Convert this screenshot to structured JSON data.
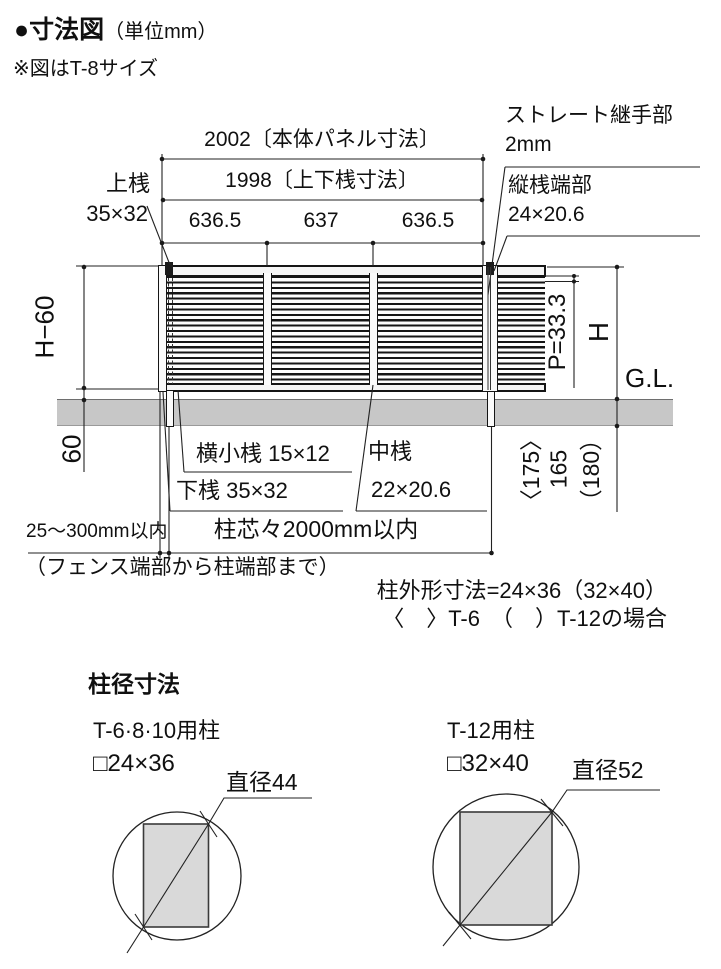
{
  "header": {
    "title": "●寸法図",
    "unit": "（単位mm）",
    "note": "※図はT-8サイズ"
  },
  "dims": {
    "panel_width": "2002〔本体パネル寸法〕",
    "rail_width": "1998〔上下桟寸法〕",
    "segments": [
      "636.5",
      "637",
      "636.5"
    ],
    "top_rail_label": "上桟",
    "top_rail_size": "35×32",
    "joint_label": "ストレート継手部",
    "joint_size": "2mm",
    "vertical_end_label": "縦桟端部",
    "vertical_end_size": "24×20.6",
    "panel_height": "H−60",
    "pitch": "P=33.3",
    "total_height": "H",
    "ground_level": "G.L.",
    "ground_clearance": "60",
    "embed_t6": "〈175〉",
    "embed_t8": "165",
    "embed_t12": "（180）",
    "small_rail": "横小桟 15×12",
    "bottom_rail": "下桟 35×32",
    "middle_rail_label": "中桟",
    "middle_rail_size": "22×20.6",
    "end_offset": "25～300mm以内",
    "post_pitch": "柱芯々2000mm以内",
    "end_offset_note": "（フェンス端部から柱端部まで）",
    "post_outer_note": "柱外形寸法=24×36（32×40）",
    "post_outer_cases": "〈　〉T-6　（　）T-12の場合"
  },
  "post_section": {
    "heading": "柱径寸法",
    "left": {
      "usage": "T-6·8·10用柱",
      "size": "□24×36",
      "diameter": "直径44"
    },
    "right": {
      "usage": "T-12用柱",
      "size": "□32×40",
      "diameter": "直径52"
    }
  },
  "colors": {
    "ground_band": "#c7c7c7",
    "post_fill": "#d9d9d9",
    "line": "#222222"
  }
}
